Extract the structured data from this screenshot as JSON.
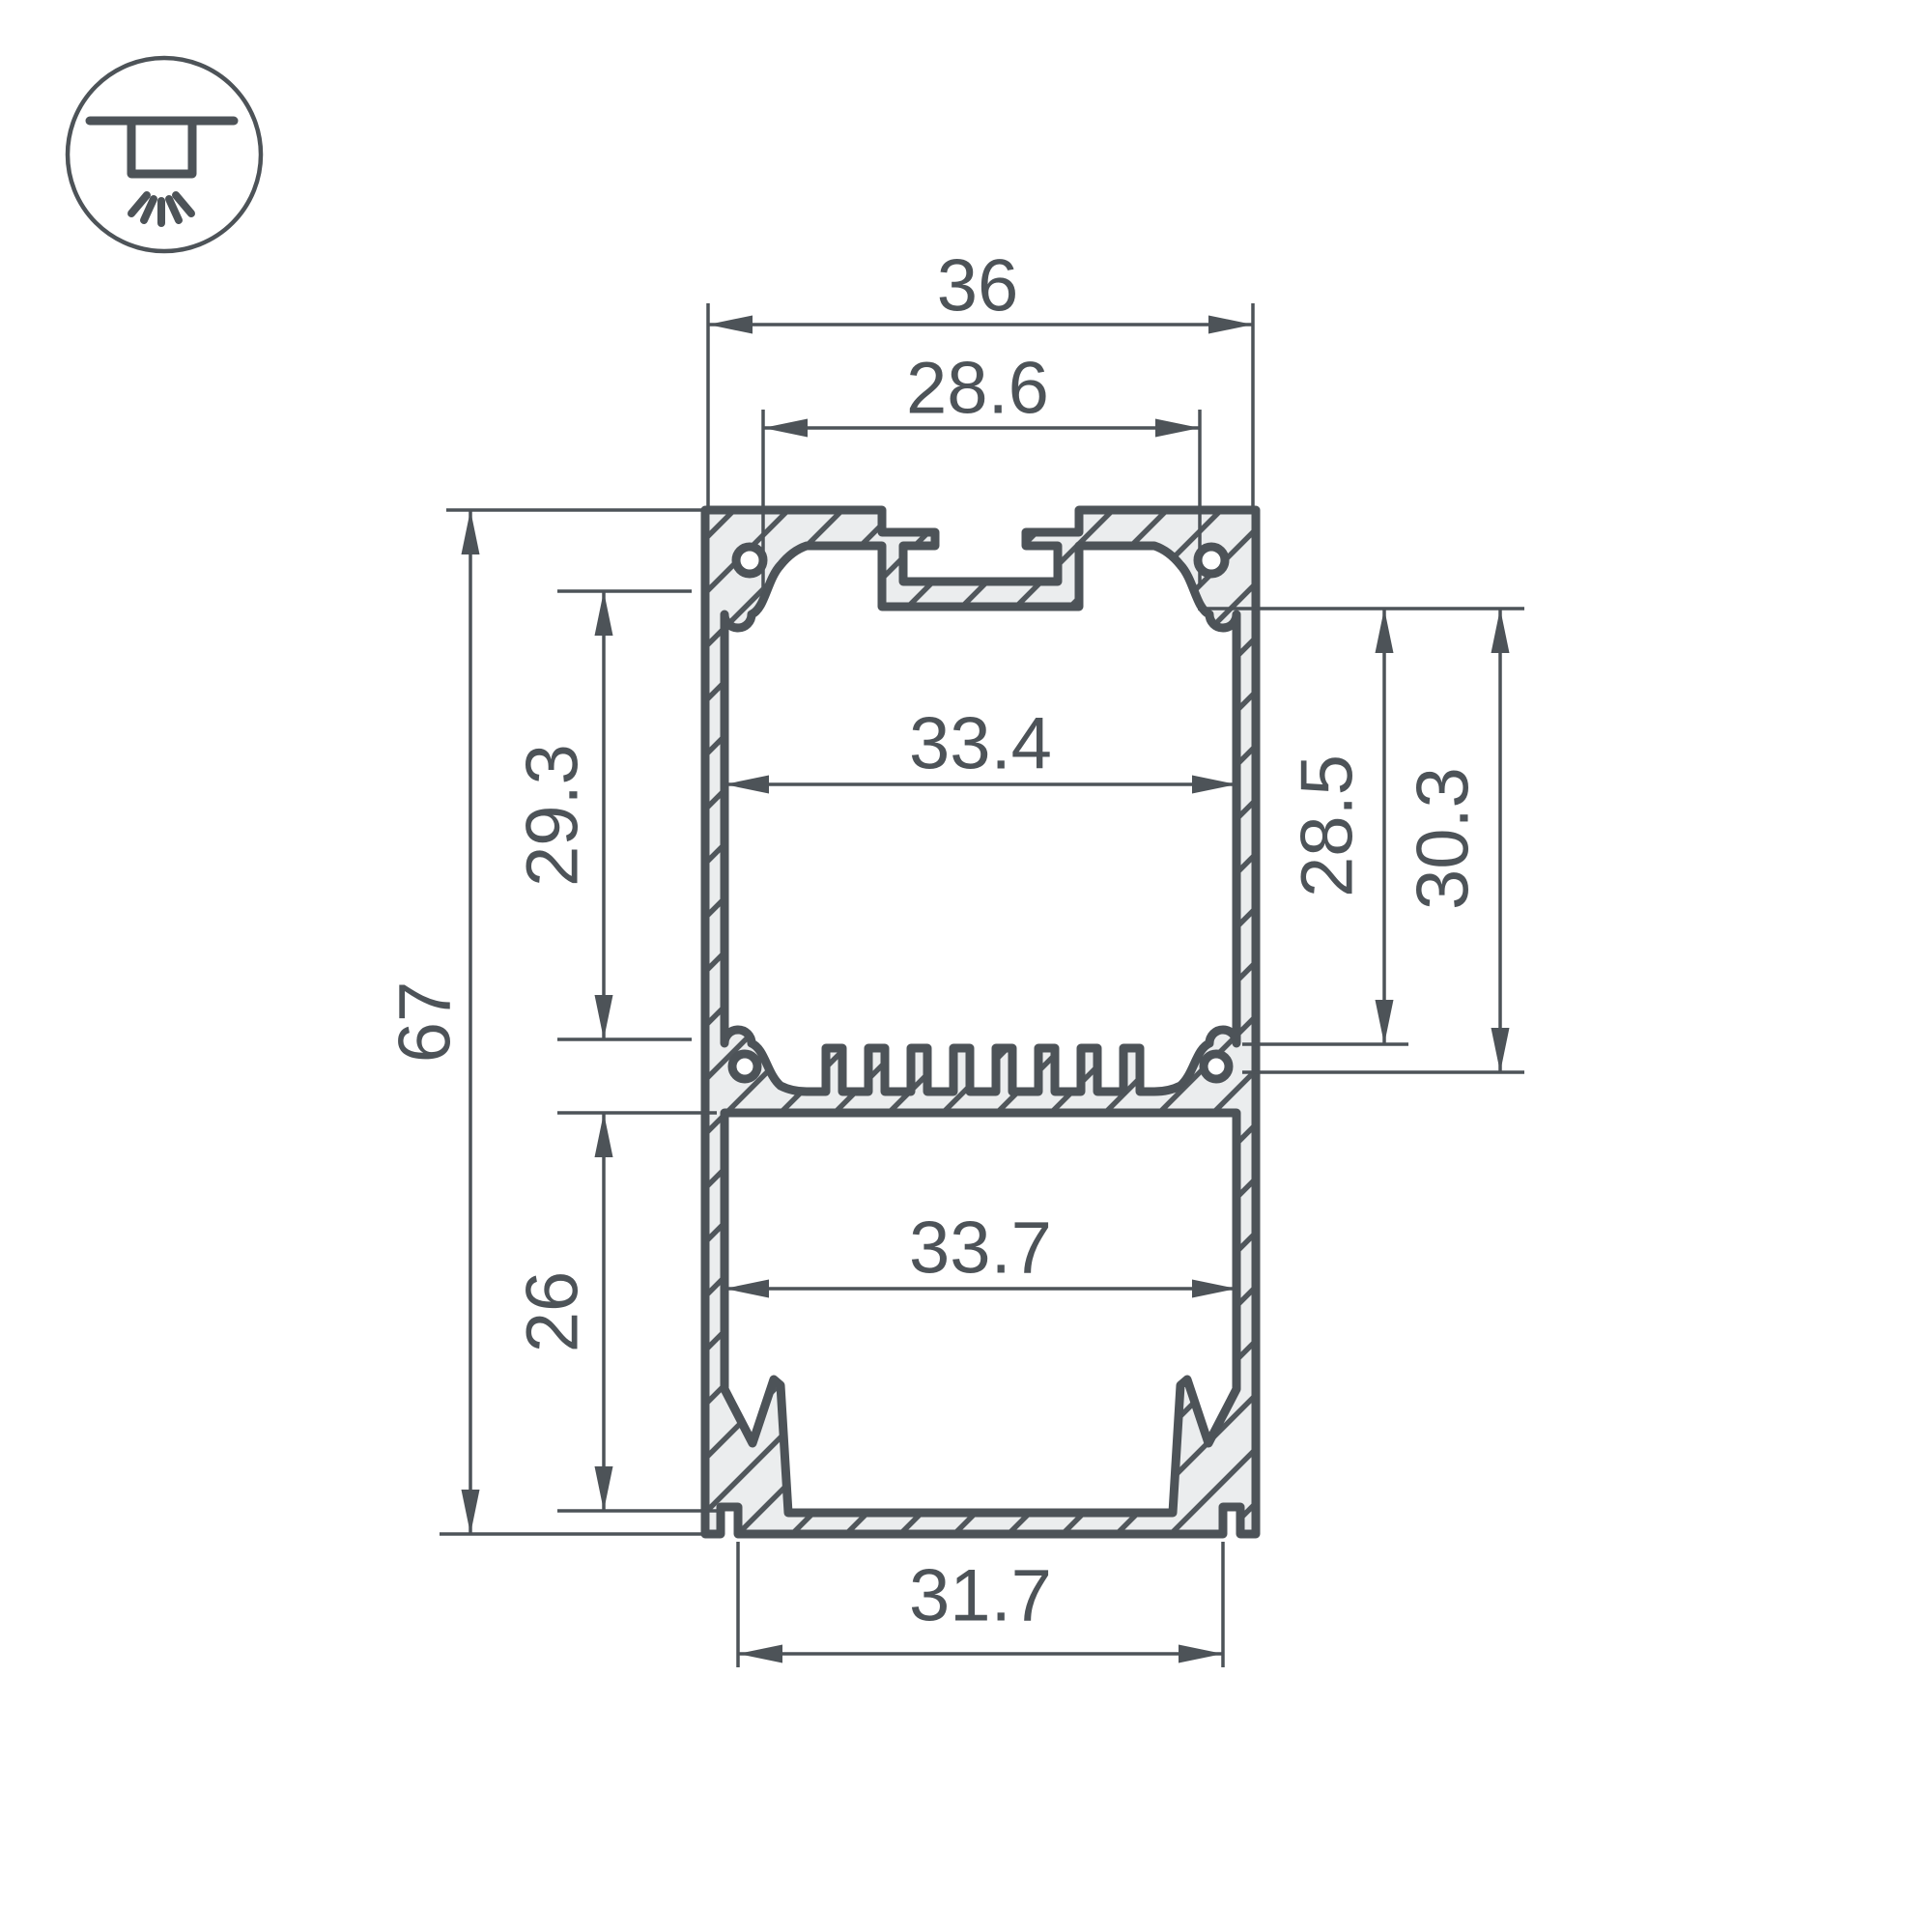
{
  "title": "LED aluminium profile cross-section technical drawing",
  "colors": {
    "line": "#4d5358",
    "text": "#4d5358",
    "material-fill": "#ebedee",
    "hatch": "#51575c",
    "background": "#ffffff"
  },
  "icon": {
    "name": "surface-ceiling-light-icon",
    "meaning": "surface / ceiling mount luminaire"
  },
  "dimensions": {
    "outer_width": "36",
    "mount_slot_spacing": "28.6",
    "upper_inner_width": "33.4",
    "upper_inner_height_left": "29.3",
    "total_height": "67",
    "lower_inner_height": "26",
    "upper_inner_height_right_min": "28.5",
    "upper_inner_height_right_max": "30.3",
    "lower_inner_width": "33.7",
    "bottom_opening_width": "31.7"
  }
}
